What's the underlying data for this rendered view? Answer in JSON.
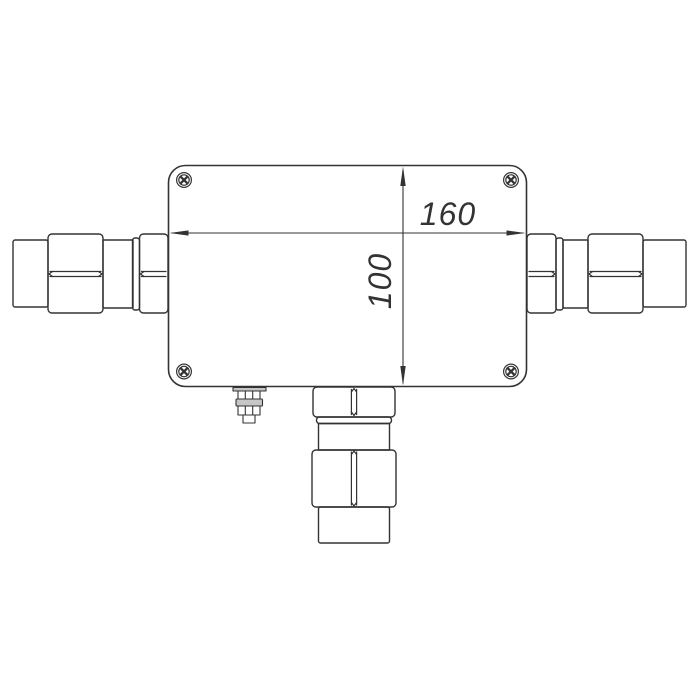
{
  "drawing": {
    "kind": "technical-dimension-drawing",
    "background": "#ffffff",
    "line_color": "#333333",
    "shade_color": "#c6c6c6",
    "dimensions": {
      "width_label": "160",
      "height_label": "100"
    },
    "parts": {
      "enclosure": "rounded rectangular enclosure with four corner screws",
      "left_connector": "left coaxial cable gland",
      "right_connector": "right coaxial cable gland",
      "bottom_connector": "bottom coaxial cable gland",
      "vent": "small breather vent fitting"
    }
  }
}
